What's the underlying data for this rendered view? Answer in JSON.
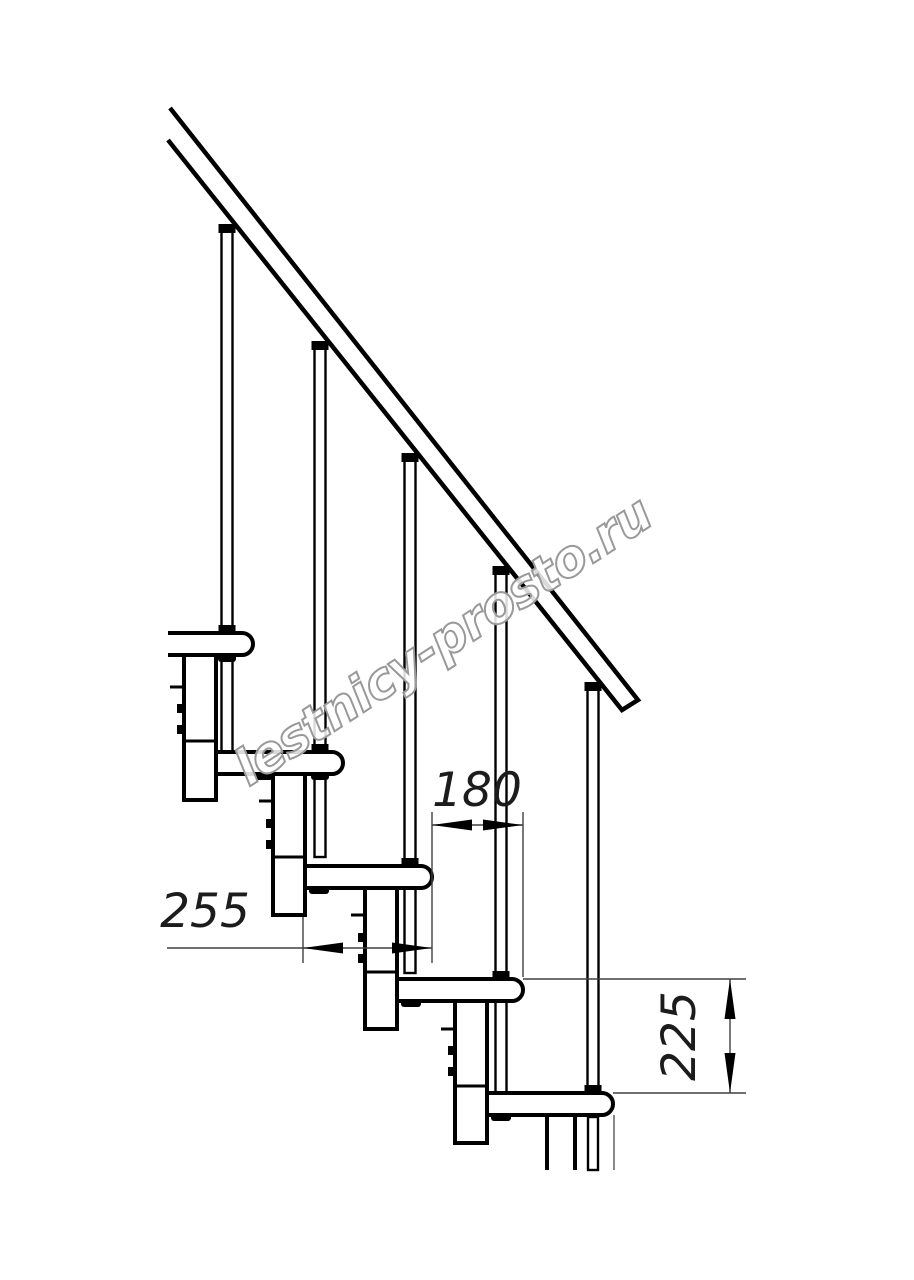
{
  "watermark": {
    "text": "lestnicy-prosto.ru"
  },
  "dimensions": {
    "step_run": {
      "value": "180"
    },
    "tread_depth": {
      "value": "255"
    },
    "step_height": {
      "value": "225"
    }
  },
  "components": {
    "handrail_count": 1,
    "baluster_count": 5,
    "tread_count": 5,
    "support_column_count": 5
  },
  "colors": {
    "background": "#ffffff",
    "drawing_line": "#000000",
    "dimension_line": "#404040",
    "watermark_outline": "#999999",
    "watermark_fill": "#ffffff"
  }
}
